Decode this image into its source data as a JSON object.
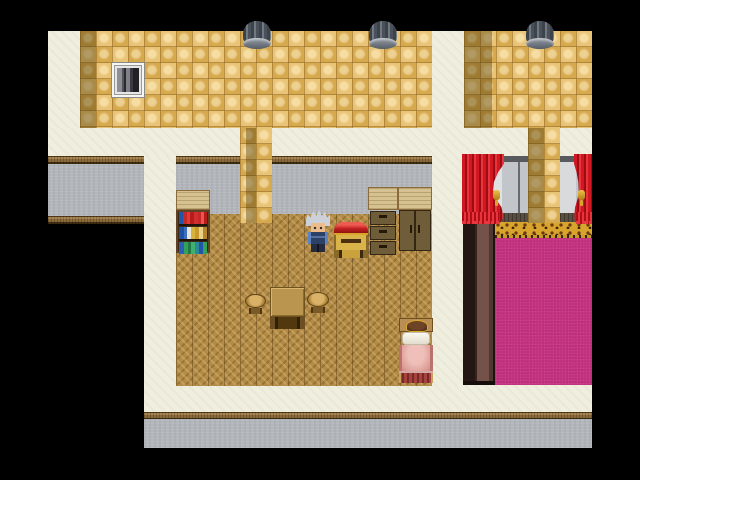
{
  "scene": {
    "title": "RPG top-down interior scene",
    "visible_text": "",
    "canvas": {
      "width": 640,
      "height": 480,
      "letterbox_color": "#000000"
    },
    "page_background": "#ffffff"
  },
  "palette": {
    "cream_border": "#f0eedf",
    "wall_tile_light": "#e9c477",
    "wall_tile_dark": "#d7a94f",
    "wall_shadow": "#8f7339",
    "gray_wall": "#b3b6bb",
    "wood_trim": "#8a6a3a",
    "parquet_floor": "#b28b47",
    "carpet_magenta": "#c23180",
    "leopard_gold": "#d8a42e",
    "curtain_red": "#d01722",
    "brown_column": "#33241f",
    "vent_gray": "#4a515a"
  },
  "entities": {
    "canvas": "game viewport",
    "wall": "tan checkered wall with shadow columns",
    "window": "small wall window with gray drapes",
    "vent1": "round metal roof vent",
    "vent2": "round metal roof vent",
    "vent3": "round metal roof vent",
    "pillar1": "tan tile pillar",
    "pillar2": "tan tile pillar",
    "bookshelf": "bookshelf with three shelves of colored books",
    "chest": "red-lidded gold chest cabinet",
    "dresser": "three-drawer dresser with light wood top",
    "wardrobe": "two-door wardrobe with light wood top",
    "table": "square wooden table",
    "stool_left": "round wooden stool",
    "stool_right": "round wooden stool",
    "bed": "bed with white pillow, pink blanket and striped footboard",
    "character": "hero sprite, silver spiky hair, blue outfit, facing down",
    "curtain_left": "red curtain with gold tieback",
    "curtain_right": "red curtain with gold tieback (clipped by map edge)",
    "window_panel": "gray window wall panel",
    "leopard_border": "leopard-print carpet border",
    "carpet": "magenta carpet",
    "brown_column": "dark brown wall column"
  }
}
